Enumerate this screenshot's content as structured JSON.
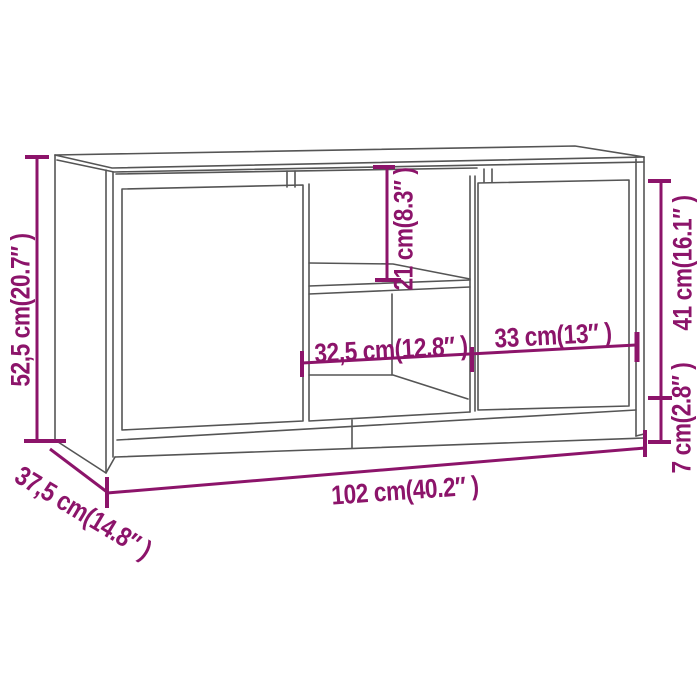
{
  "colors": {
    "accent": "#8C146A",
    "line": "#555555",
    "bg": "#FFFFFF"
  },
  "labels": {
    "height": "52,5 cm(20.7″ )",
    "depth": "37,5 cm(14.8″ )",
    "width": "102 cm(40.2″ )",
    "opening_height": "21 cm(8.3″ )",
    "opening_width": "32,5 cm(12.8″ )",
    "door_width": "33 cm(13″ )",
    "door_height": "41 cm(16.1″ )",
    "base_height": "7 cm(2.8″ )"
  }
}
